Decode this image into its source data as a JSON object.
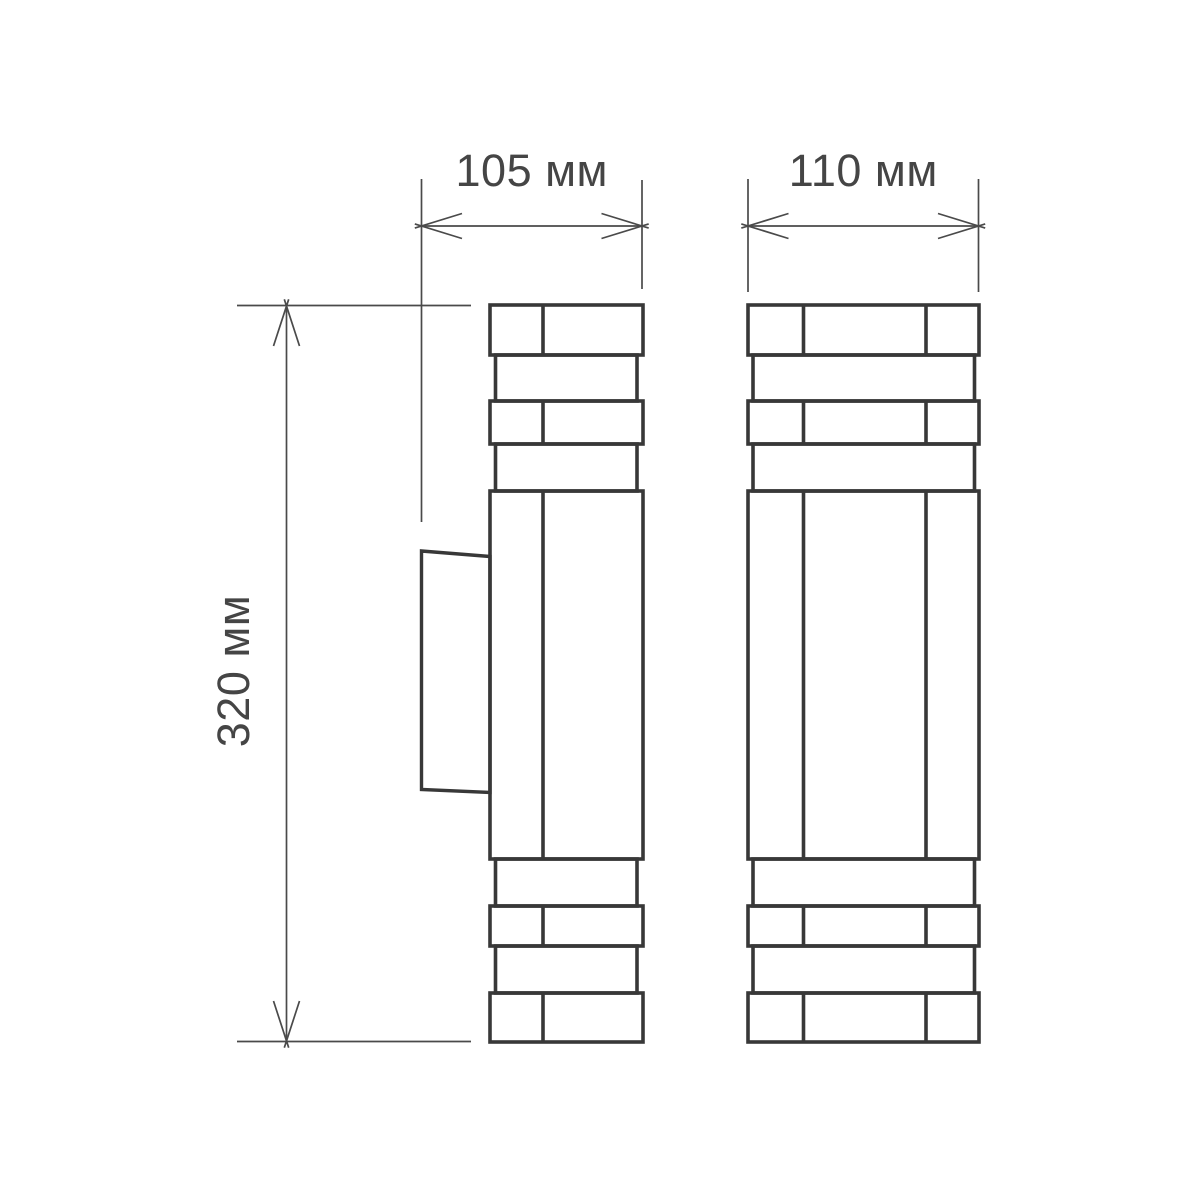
{
  "drawing": {
    "type": "technical-dimension-drawing",
    "subject": "wall sconce luminaire, two orthographic views",
    "views": {
      "side_view": "left view with wall-mount bracket",
      "front_view": "right view"
    },
    "dimensions": {
      "side_width_label": "105 мм",
      "front_width_label": "110 мм",
      "height_label": "320 мм"
    },
    "colors": {
      "background": "#ffffff",
      "outline": "#383838",
      "dimension": "#4a4a4a",
      "text": "#454545"
    }
  }
}
